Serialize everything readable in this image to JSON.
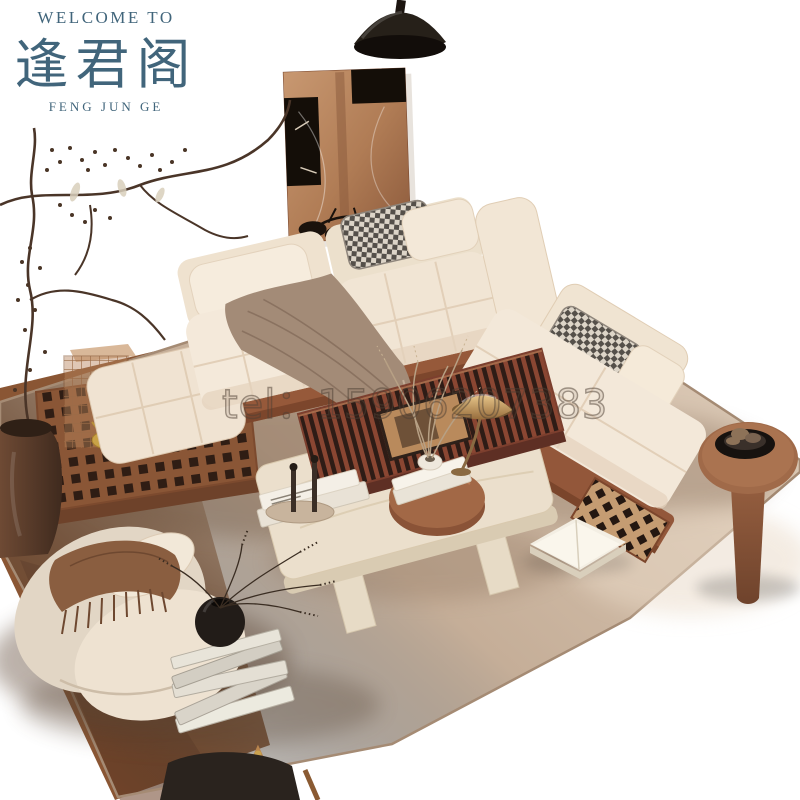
{
  "brand": {
    "welcome": "WELCOME TO",
    "name_cn": "逢君阁",
    "name_en": "FENG JUN GE"
  },
  "watermark": {
    "text": "tel：15906207383"
  },
  "palette": {
    "bg": "#ffffff",
    "brand-teal": "#41657b",
    "watermark-ink": "rgba(77,63,52,0.5)",
    "rug-light": "#d8c6b3",
    "rug-dark": "#a98c73",
    "wood-floor": "#8a5634",
    "sofa-cream": "#f3e8d9",
    "sofa-base-wood": "#96593a",
    "throw-taupe": "#a38b77",
    "art-copper": "#b9825c",
    "brass": "#c79d63",
    "slat-red": "#8a4632",
    "table-travertine": "#ebdfcc",
    "table-round-brown": "#a26846",
    "chair-dark": "#2a231e"
  },
  "scene": {
    "items": [
      "pendant-lamp",
      "wall-art",
      "hanging-branches",
      "clay-vase",
      "grid-platform",
      "wire-cage-lantern",
      "gold-ornament",
      "modular-sofa",
      "throw-blanket",
      "houndstooth-pillow",
      "chaise-sofa",
      "round-side-table",
      "decor-bowl",
      "travertine-coffee-table",
      "slatted-tray-table",
      "round-nesting-table",
      "brass-table-lamp",
      "candlesticks",
      "coffee-table-books",
      "dried-grass-vase",
      "boucle-armchair",
      "fringed-throw",
      "book-stack",
      "black-round-vase",
      "open-book",
      "area-rug",
      "wood-floor",
      "black-chair"
    ]
  }
}
